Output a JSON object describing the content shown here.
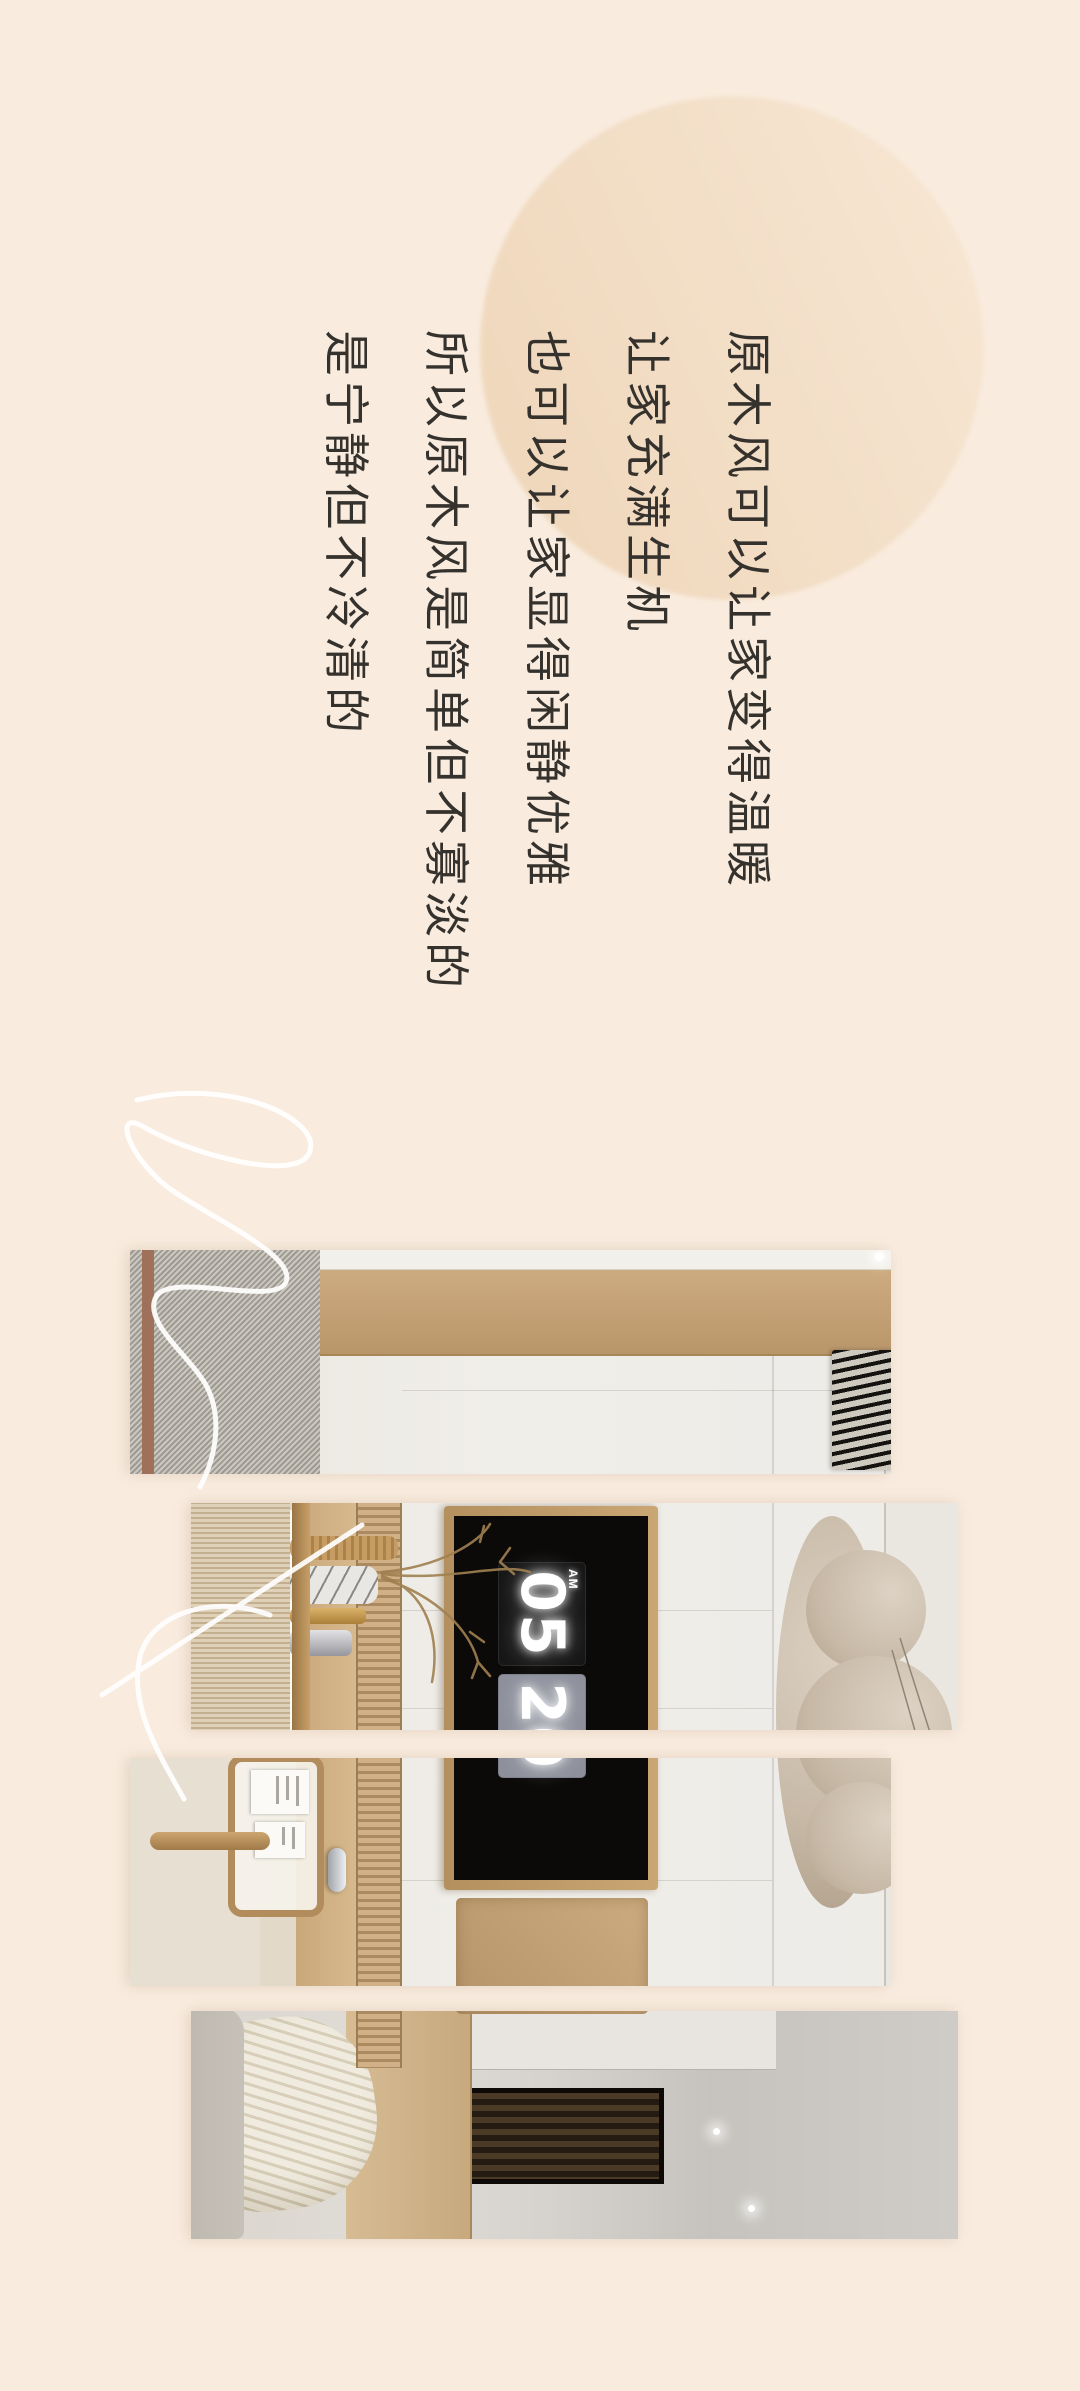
{
  "canvas": {
    "bg_color": "#f9ecdf"
  },
  "decor_circle": {
    "gradient_start": "#f7e7d4",
    "gradient_end": "#eed5b8"
  },
  "headline": {
    "color": "#35322e",
    "lines": [
      "原木风可以让家变得温暖",
      "让家充满生机",
      "也可以让家显得闲静优雅",
      "所以原木风是简单但不寡淡的",
      "是宁静但不冷清的"
    ]
  },
  "photo": {
    "clock": {
      "meridiem": "AM",
      "hour": "05",
      "minute": "20",
      "panel_color": "#0b0a08",
      "hour_card_color": "#161616",
      "minute_card_color": "#8d909b",
      "digit_color": "#ffffff"
    },
    "palette": {
      "wall": "#efede9",
      "wood_trim": "#c5a377",
      "fluted_band": "#c9a97c",
      "cloud_lamp": "#cdbfae",
      "boucle_fabric": "#b5b0a7",
      "linen_curtain": "#d8c6a8",
      "headboard": "#d3b68d"
    }
  },
  "signature": {
    "color": "#ffffff"
  }
}
